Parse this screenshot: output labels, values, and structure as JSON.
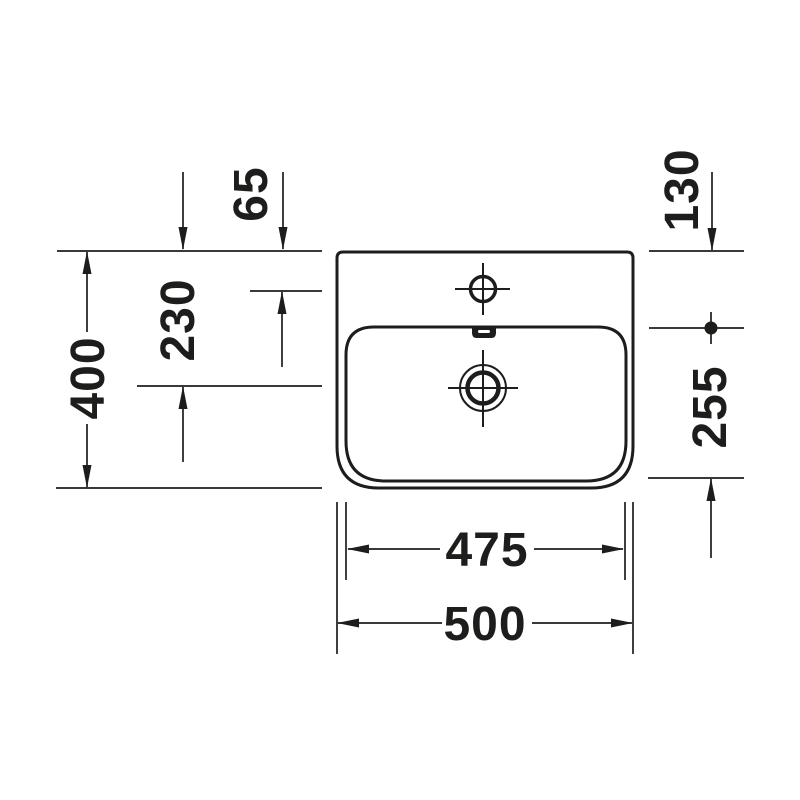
{
  "canvas": {
    "background_color": "#ffffff",
    "line_color": "#1d1d1b"
  },
  "drawing": {
    "kind": "washbasin-top-view-dimension-drawing",
    "labels": {
      "tap_hole_offset_from_rear": "65",
      "rear_edge_to_basin_rim": "130",
      "drain_center_offset_from_rear": "230",
      "overall_depth": "400",
      "basin_depth": "255",
      "basin_width": "475",
      "overall_width": "500"
    }
  }
}
